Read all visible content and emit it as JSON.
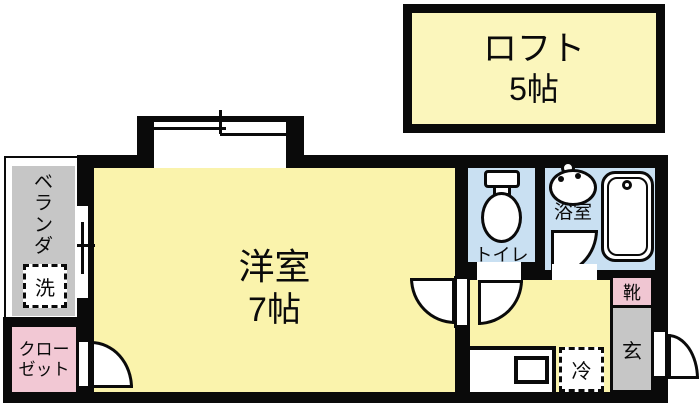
{
  "plan": {
    "loft": {
      "label": "ロフト",
      "size": "5帖"
    },
    "main_room": {
      "label": "洋室",
      "size": "7帖"
    },
    "balcony": {
      "label": "ベランダ"
    },
    "washing_machine": {
      "label": "洗"
    },
    "closet": {
      "label": "クローゼット",
      "line1": "クロー",
      "line2": "ゼット"
    },
    "toilet": {
      "label": "トイレ"
    },
    "bathroom": {
      "label": "浴室"
    },
    "entrance": {
      "label": "玄"
    },
    "shoe_cabinet": {
      "label": "靴"
    },
    "refrigerator": {
      "label": "冷"
    }
  },
  "colors": {
    "wall": "#0a0a0a",
    "room_yellow": "#faf3ac",
    "loft_yellow": "#fbf6bc",
    "wet_area_blue": "#c9e0f2",
    "closet_pink": "#f2c8d4",
    "shoe_pink": "#f0c6d2",
    "balcony_gray": "#c6c6c6"
  }
}
